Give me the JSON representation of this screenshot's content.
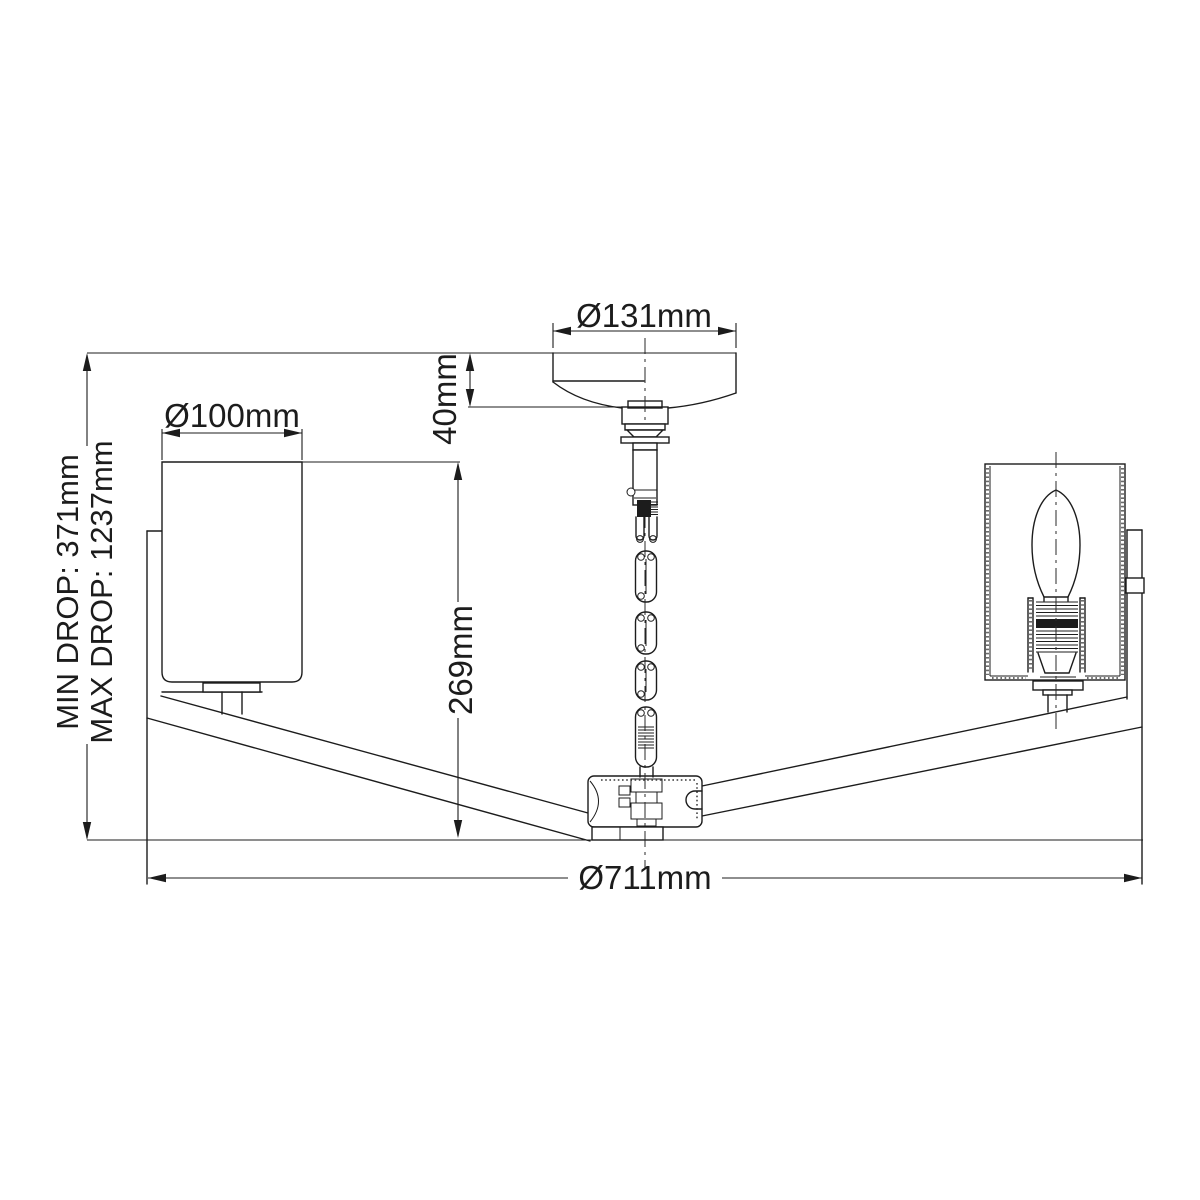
{
  "title": "Chandelier technical dimension drawing",
  "dimensions": {
    "canopy_diameter": "Ø131mm",
    "canopy_height": "40mm",
    "shade_diameter": "Ø100mm",
    "body_height": "269mm",
    "min_drop": "MIN DROP: 371mm",
    "max_drop": "MAX DROP: 1237mm",
    "overall_diameter": "Ø711mm"
  },
  "colors": {
    "line": "#1c1c1c",
    "background": "#ffffff"
  }
}
